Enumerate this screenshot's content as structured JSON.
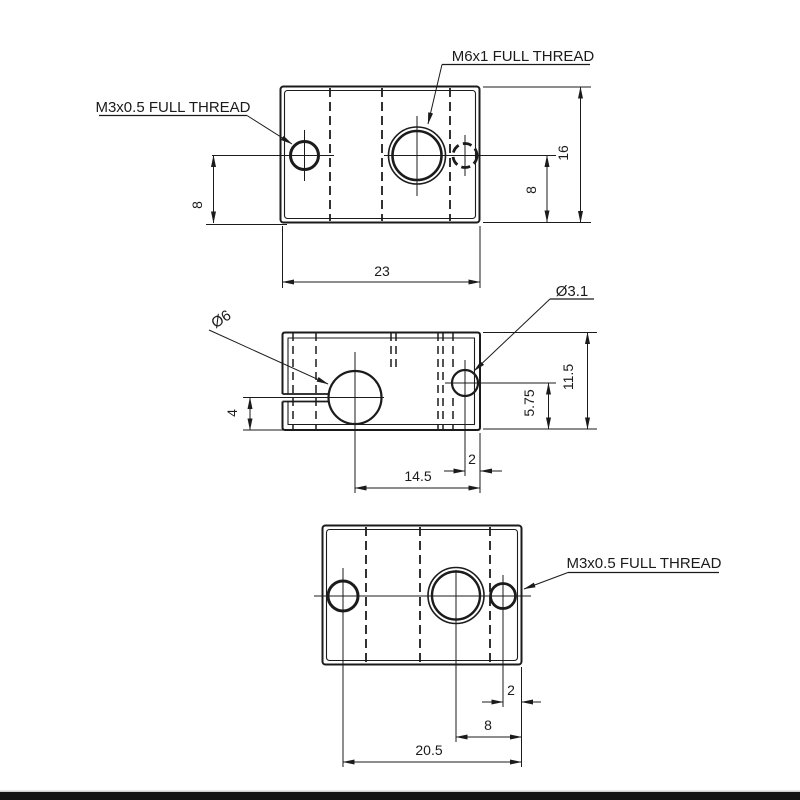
{
  "meta": {
    "background_color": "#ffffff",
    "line_color": "#1b1b1b",
    "bottom_bar_color": "#141414"
  },
  "labels": {
    "m6_thread": "M6x1 FULL THREAD",
    "m3_thread_top": "M3x0.5 FULL THREAD",
    "m3_thread_bottom": "M3x0.5 FULL THREAD",
    "dia_6": "Ø6",
    "dia_3_1": "Ø3.1"
  },
  "dimensions": {
    "top_view": {
      "left_hole_8": "8",
      "right_hole_8": "8",
      "height_16": "16",
      "width_23": "23"
    },
    "front_view": {
      "slot_4": "4",
      "hole_5_75": "5.75",
      "height_11_5": "11.5",
      "center_14_5": "14.5",
      "edge_2": "2"
    },
    "bottom_view": {
      "edge_2": "2",
      "center_8": "8",
      "width_20_5": "20.5"
    }
  }
}
